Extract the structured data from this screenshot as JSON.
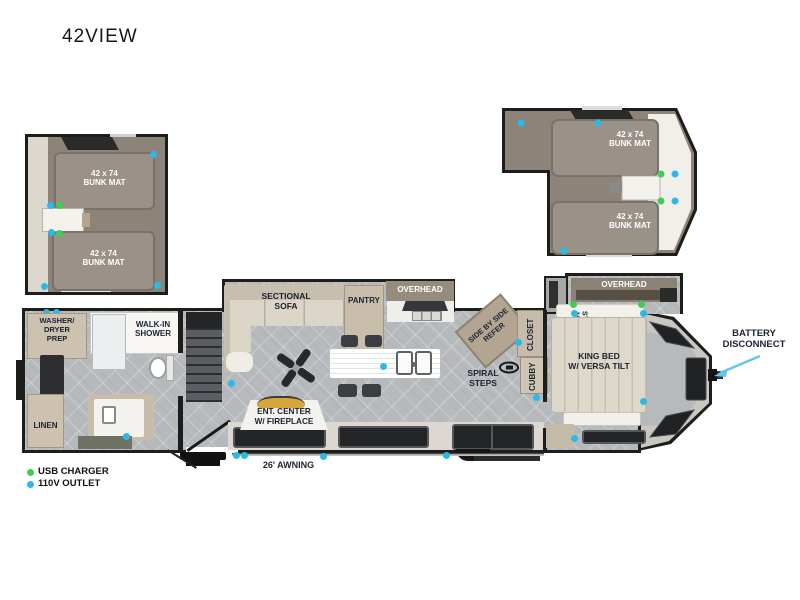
{
  "title": "42VIEW",
  "legend": {
    "usb_charger": "USB CHARGER",
    "outlet_110v": "110V OUTLET"
  },
  "colors": {
    "usb_charger_dot": "#43cb57",
    "outlet_110v_dot": "#2cb9e8",
    "wall": "#1d1d1b",
    "loft_floor": "#8d8379",
    "bunk_mat": "#9a9289",
    "main_floor_tile": "#b7babd",
    "cabinet": "#cdc2b0",
    "fireplace_accent": "#d9a63e",
    "battery_arrow": "#62c8e6"
  },
  "labels": {
    "bunk_mat": "42 x 74\nBUNK MAT",
    "sectional_sofa": "SECTIONAL\nSOFA",
    "pantry": "PANTRY",
    "overhead": "OVERHEAD",
    "washer_dryer_prep": "WASHER/\nDRYER\nPREP",
    "walk_in_shower": "WALK-IN\nSHOWER",
    "linen": "LINEN",
    "ent_center": "ENT. CENTER\nW/ FIREPLACE",
    "spiral_steps": "SPIRAL\nSTEPS",
    "side_by_side_refer": "SIDE BY SIDE\nREFER",
    "closet": "CLOSET",
    "cubby": "CUBBY",
    "night_stand": "NIGHT\nSTAND",
    "king_bed": "KING BED\nW/ VERSA TILT",
    "battery_disconnect": "BATTERY\nDISCONNECT",
    "awning": "26' AWNING"
  }
}
